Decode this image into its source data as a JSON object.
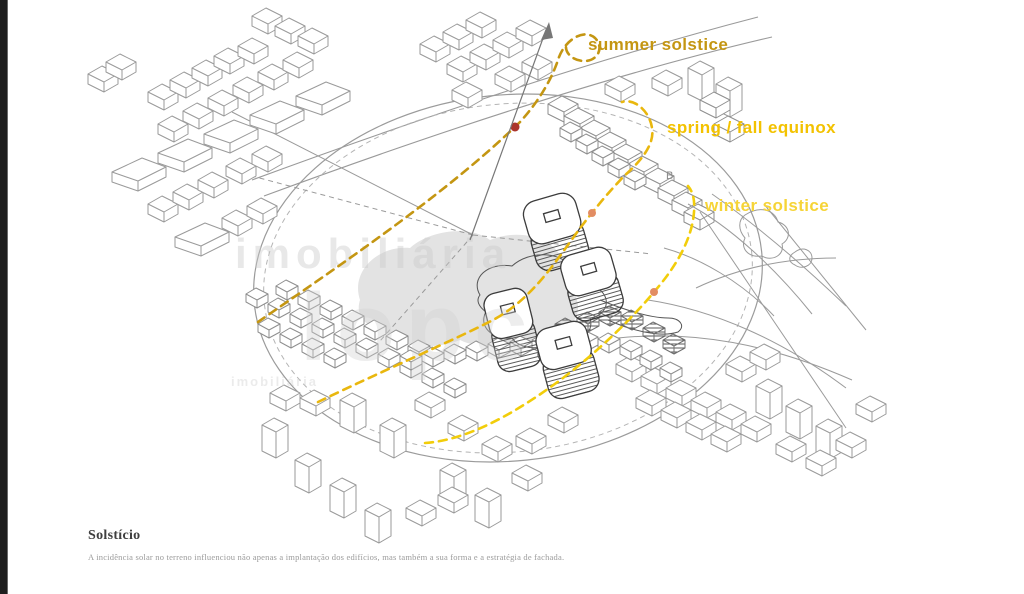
{
  "figure": {
    "sun_path_labels": {
      "summer": "summer solstice",
      "equinox": "spring / fall equinox",
      "winter": "winter solstice"
    },
    "marker_b": "B",
    "watermark": {
      "line1": "imobiliária",
      "line2": "lopc",
      "line3": "imobiliária"
    },
    "caption": {
      "title": "Solstício",
      "body": "A incidência solar no terreno influenciou não apenas a implantação dos edifícios, mas também a sua forma e a estratégia de fachada."
    },
    "colors": {
      "summer_path": "#c49612",
      "equinox_path": "#e9b70e",
      "winter_path": "#f2cd0a",
      "summer_label": "#c49612",
      "equinox_label": "#f3c200",
      "winter_label": "#f6d437",
      "sun_marker_red": "#ab352c",
      "sun_marker_orange": "#e28d63",
      "drawing_line": "#9a9a9a"
    }
  }
}
